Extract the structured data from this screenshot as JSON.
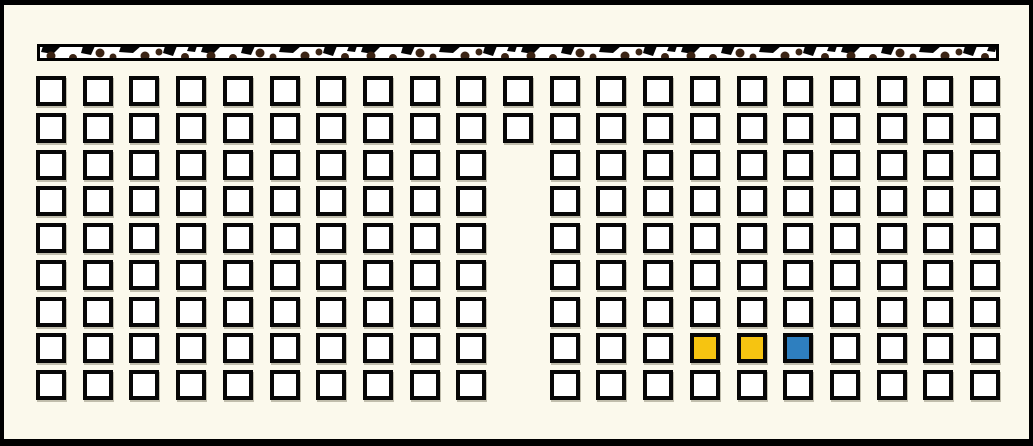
{
  "panel": {
    "width": 1033,
    "height": 446,
    "background_color": "#FBF9EC",
    "frame_color": "#000000"
  },
  "board_strip": {
    "left": 33,
    "top": 39,
    "width": 962,
    "height": 17,
    "base_color": "#FFFFFF",
    "edge_color": "#000000",
    "mark_color": "#050505",
    "dot_color": "#3B2414"
  },
  "seat_grid": {
    "rows": 9,
    "cols": 21,
    "origin_x": 32,
    "origin_y": 71,
    "pitch_x": 46.7,
    "pitch_y": 36.77,
    "cell_size": 30,
    "cell_fill": "#FFFFFF",
    "cell_border_color": "#070707",
    "missing_cells": [
      [
        2,
        10
      ],
      [
        3,
        10
      ],
      [
        4,
        10
      ],
      [
        5,
        10
      ],
      [
        6,
        10
      ],
      [
        7,
        10
      ],
      [
        8,
        10
      ]
    ],
    "colored_cells": [
      {
        "row": 7,
        "col": 14,
        "color": "#F6C411"
      },
      {
        "row": 7,
        "col": 15,
        "color": "#F6C411"
      },
      {
        "row": 7,
        "col": 16,
        "color": "#2E7FBF"
      }
    ]
  }
}
